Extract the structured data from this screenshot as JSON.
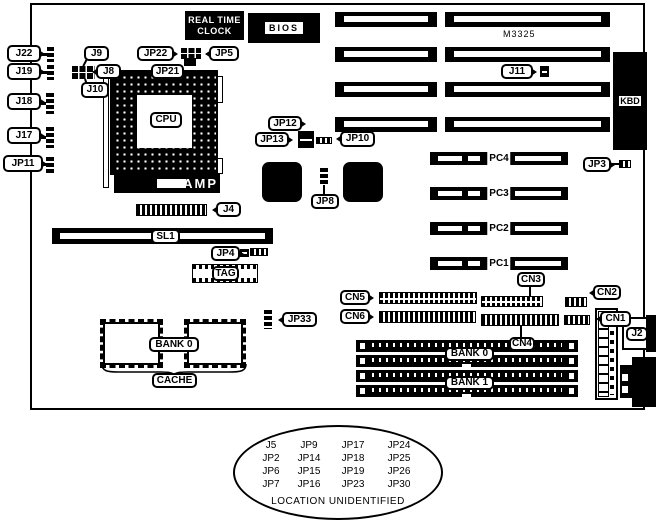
{
  "labels": {
    "rtc1": "REAL TIME",
    "rtc2": "CLOCK",
    "bios": "BIOS",
    "m3325": "M3325",
    "kbd": "KBD",
    "cpu": "CPU",
    "amp": "AMP",
    "j22": "J22",
    "j19": "J19",
    "j18": "J18",
    "j17": "J17",
    "jp11": "JP11",
    "j9": "J9",
    "j8": "J8",
    "j10": "J10",
    "jp22": "JP22",
    "jp21": "JP21",
    "jp5": "JP5",
    "j11": "J11",
    "jp12": "JP12",
    "jp13": "JP13",
    "jp10": "JP10",
    "jp8": "JP8",
    "jp3": "JP3",
    "j4": "J4",
    "sl1": "SL1",
    "jp4": "JP4",
    "tag": "TAG",
    "jp33": "JP33",
    "pc4": "PC4",
    "pc3": "PC3",
    "pc2": "PC2",
    "pc1": "PC1",
    "cn5": "CN5",
    "cn6": "CN6",
    "cn3": "CN3",
    "cn2": "CN2",
    "cn4": "CN4",
    "cn1": "CN1",
    "j2": "J2",
    "bank0_cache": "BANK 0",
    "cache": "CACHE",
    "bank0": "BANK 0",
    "bank1": "BANK 1"
  },
  "unidentified": {
    "rows": [
      [
        "J5",
        "JP9",
        "JP17",
        "JP24"
      ],
      [
        "JP2",
        "JP14",
        "JP18",
        "JP25"
      ],
      [
        "JP6",
        "JP15",
        "JP19",
        "JP26"
      ],
      [
        "JP7",
        "JP16",
        "JP23",
        "JP30"
      ]
    ],
    "note": "LOCATION UNIDENTIFIED"
  },
  "colors": {
    "line": "#000000",
    "fill": "#000000",
    "background": "#ffffff"
  }
}
